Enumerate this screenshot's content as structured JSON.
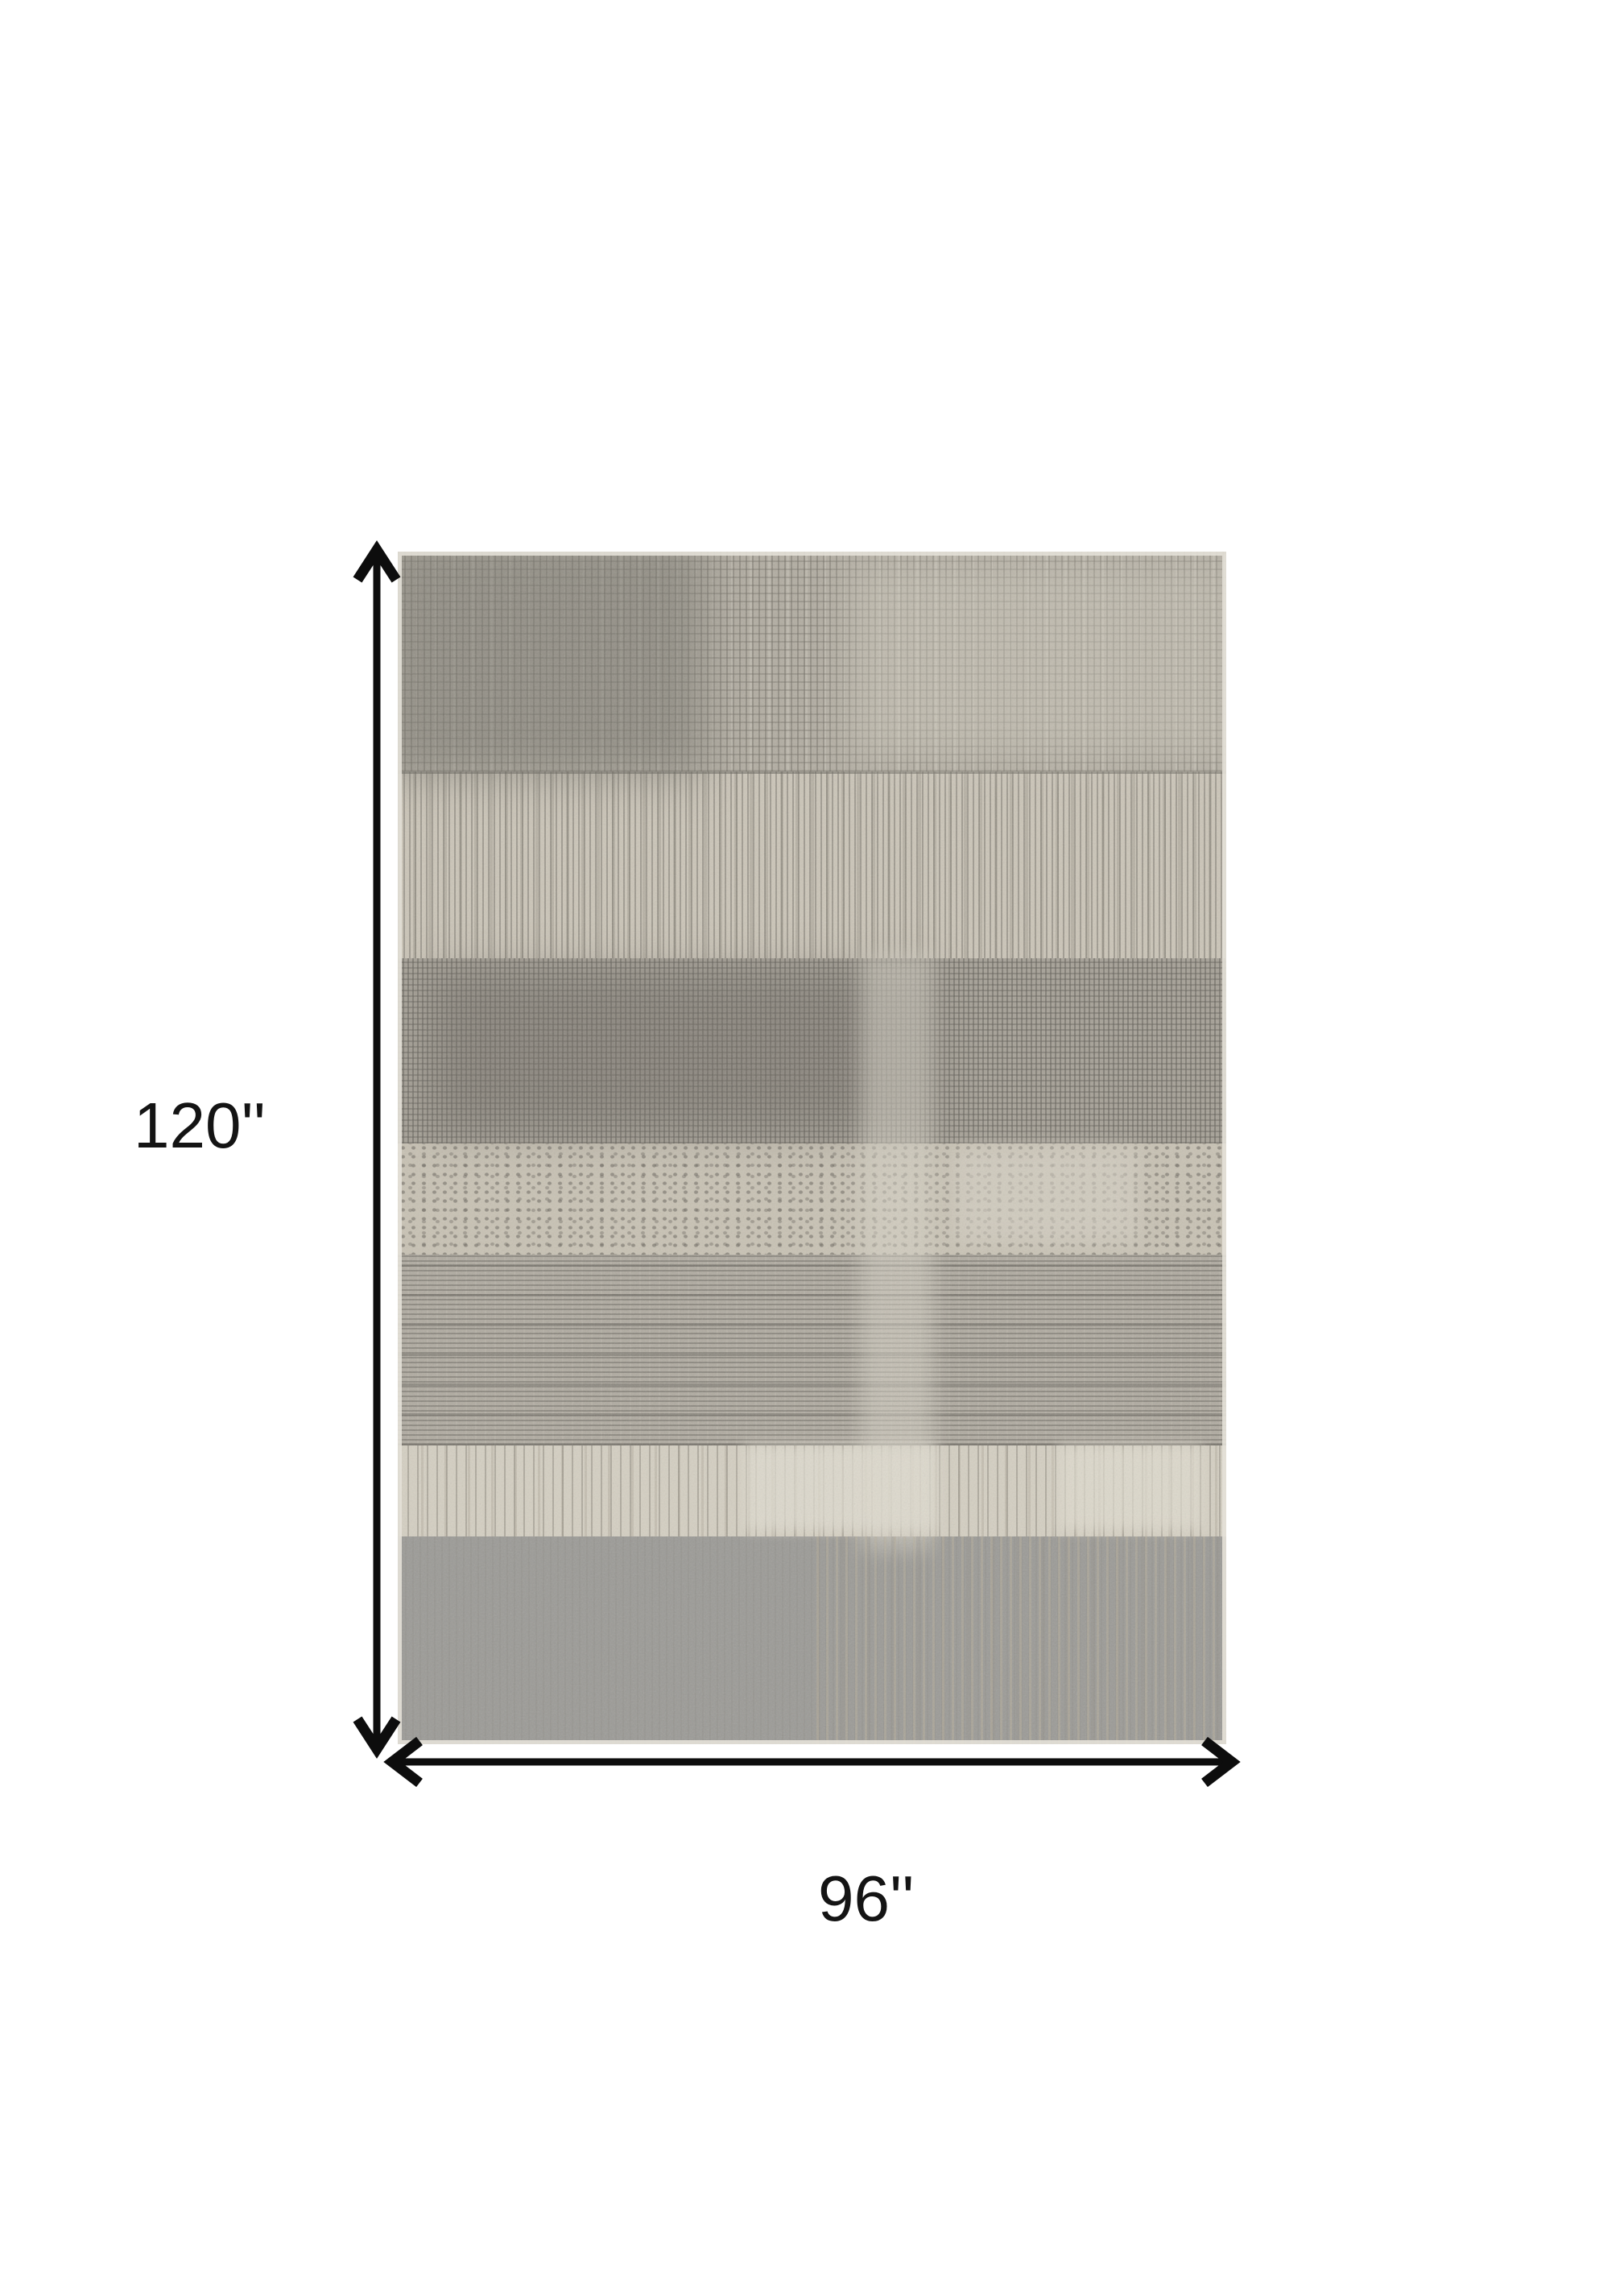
{
  "page": {
    "background_color": "#ffffff",
    "content_type": "rug product dimension diagram"
  },
  "dimensions": {
    "height": {
      "label": "120''",
      "value": 120,
      "unit": "inches"
    },
    "width": {
      "label": "96''",
      "value": 96,
      "unit": "inches"
    }
  },
  "annotation_style": {
    "arrow_color": "#0d0d0d",
    "label_color": "#141414"
  },
  "rug": {
    "style": "distressed abstract patchwork",
    "colors": {
      "ivory": "#d5d0c3",
      "light_gray_beige": "#c7c1b4",
      "mid_gray": "#aba69b",
      "dark_gray": "#9c9b96",
      "taupe_streak": "#b3a994",
      "binding_edge": "#e3e0d7"
    },
    "bands": [
      {
        "name": "crosshatch-gray",
        "base": "#b2ada2"
      },
      {
        "name": "vertical-stripes-light",
        "base": "#cbc5b8"
      },
      {
        "name": "crosshatch-dark",
        "base": "#a6a197"
      },
      {
        "name": "speckled-light",
        "base": "#c8c2b4"
      },
      {
        "name": "horizontal-striations",
        "base": "#b0aba1"
      },
      {
        "name": "ivory-drips",
        "base": "#d4cfc2"
      },
      {
        "name": "solid-gray",
        "base": "#9c9b97"
      }
    ]
  }
}
